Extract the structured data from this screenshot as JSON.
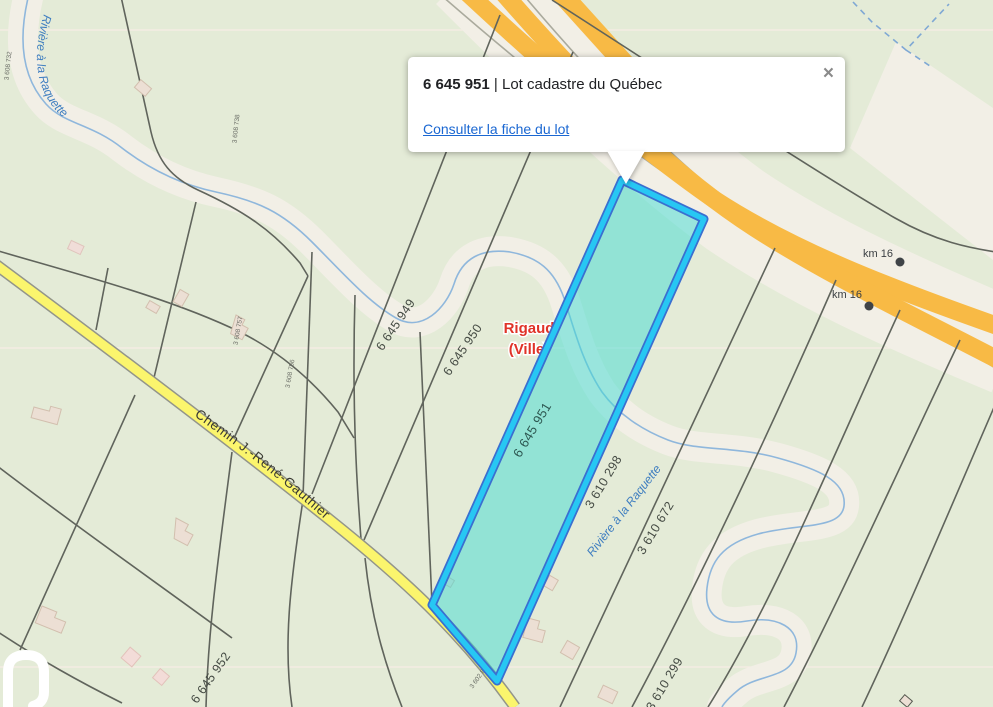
{
  "popup": {
    "lot_id": "6 645 951",
    "separator": "|",
    "title": "Lot cadastre du Québec",
    "link_label": "Consulter la fiche du lot",
    "close_label": "×"
  },
  "map": {
    "municipality": {
      "line1": "Rigaud",
      "line2": "(Ville)"
    },
    "road_label": "Chemin J.-René-Gauthier",
    "river_label": "Rivière à la Raquette",
    "km_markers": [
      {
        "label": "km 16"
      },
      {
        "label": "km 16"
      }
    ],
    "selected_lot": {
      "id": "6 645 951"
    },
    "lot_labels": [
      {
        "id": "6 645 949"
      },
      {
        "id": "6 645 950"
      },
      {
        "id": "3 610 298"
      },
      {
        "id": "3 610 672"
      },
      {
        "id": "6 645 952"
      },
      {
        "id": "3 610 299"
      }
    ],
    "small_lot_labels": [
      {
        "id": "3 608 732"
      },
      {
        "id": "3 608 738"
      },
      {
        "id": "3 608 757"
      },
      {
        "id": "3 608 756"
      },
      {
        "id": "3 602 886"
      }
    ],
    "colors": {
      "map_green": "#e4ebd7",
      "corridor_cream": "#f2efe6",
      "water_blue": "#8fb7dc",
      "road_yellow": "#fbf56d",
      "highway_orange": "#f8ba45",
      "selection_cyan": "#27c7f3",
      "selection_outline": "#3a6fd0",
      "selection_fill": "#40dcd4",
      "link_blue": "#1a67d2",
      "municipal_red": "#e03328"
    }
  }
}
